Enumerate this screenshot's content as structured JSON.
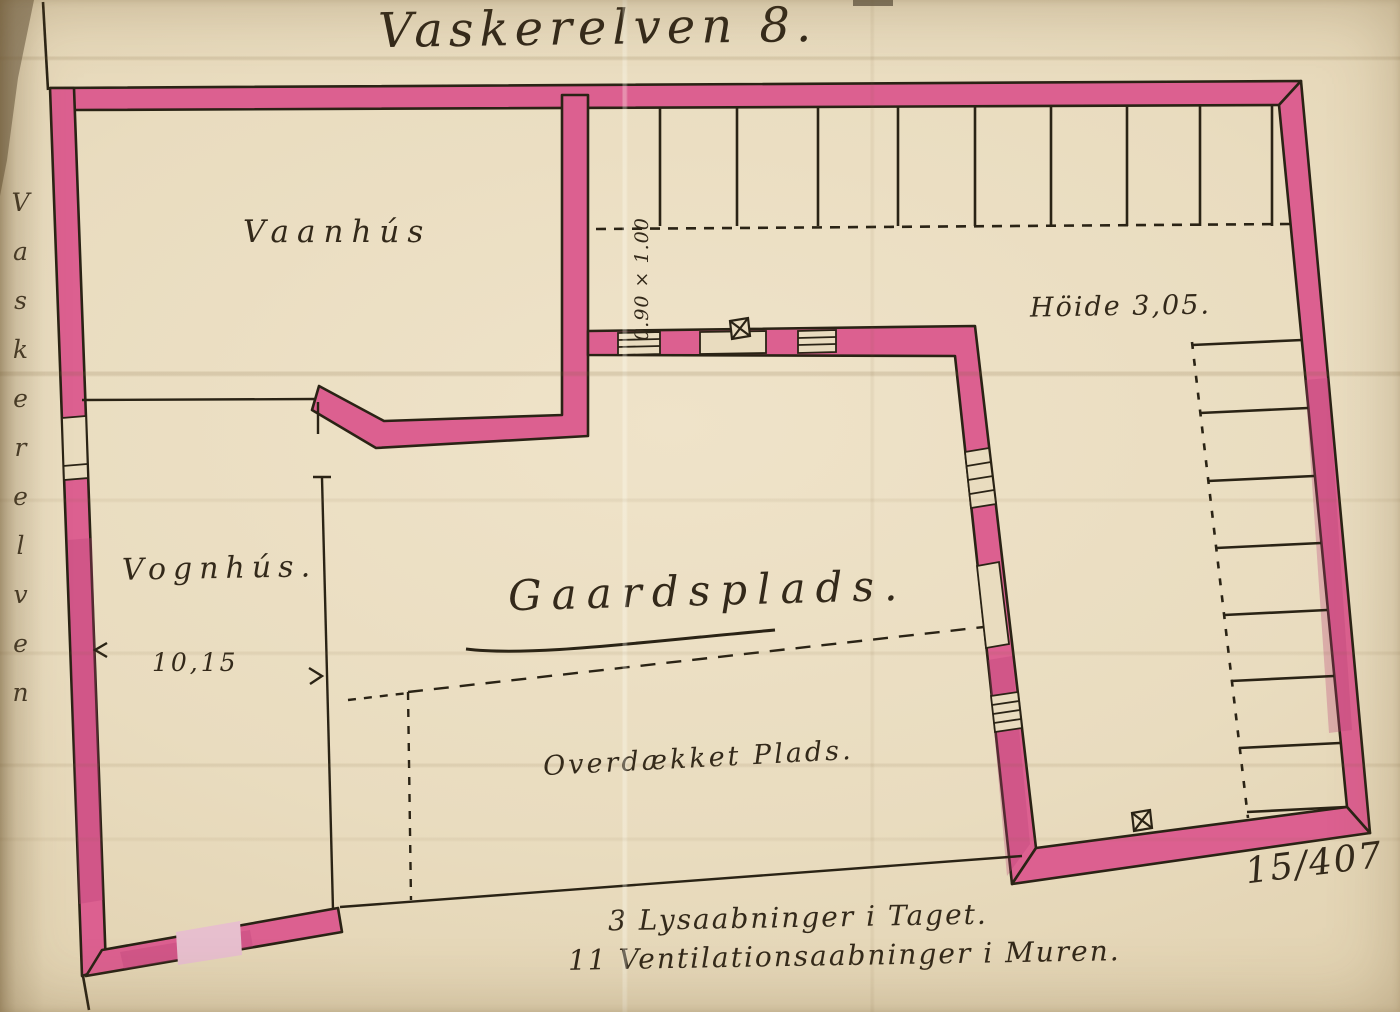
{
  "document": {
    "title": "Vaskerelven 8.",
    "street_name_vertical": "Vaskerelven",
    "archive_number": "15/407"
  },
  "labels": {
    "vaanhus": "Vaanhús",
    "vognhus": "Vognhús.",
    "vognhus_width": "10,15",
    "gaardsplads": "Gaardsplads.",
    "overdaekket_plads": "Overdækket Plads.",
    "height_note": "Höide 3,05.",
    "gate_dimension": "0.90 × 1.00"
  },
  "notes": {
    "roof_lights": "3 Lysaabninger i Taget.",
    "wall_vents": "11 Ventilationsaabninger i Muren."
  },
  "colors": {
    "wall_fill": "#dc6090",
    "wall_shade": "#b93f78",
    "ink": "#2a2315",
    "paper": "#e9dcbf"
  }
}
